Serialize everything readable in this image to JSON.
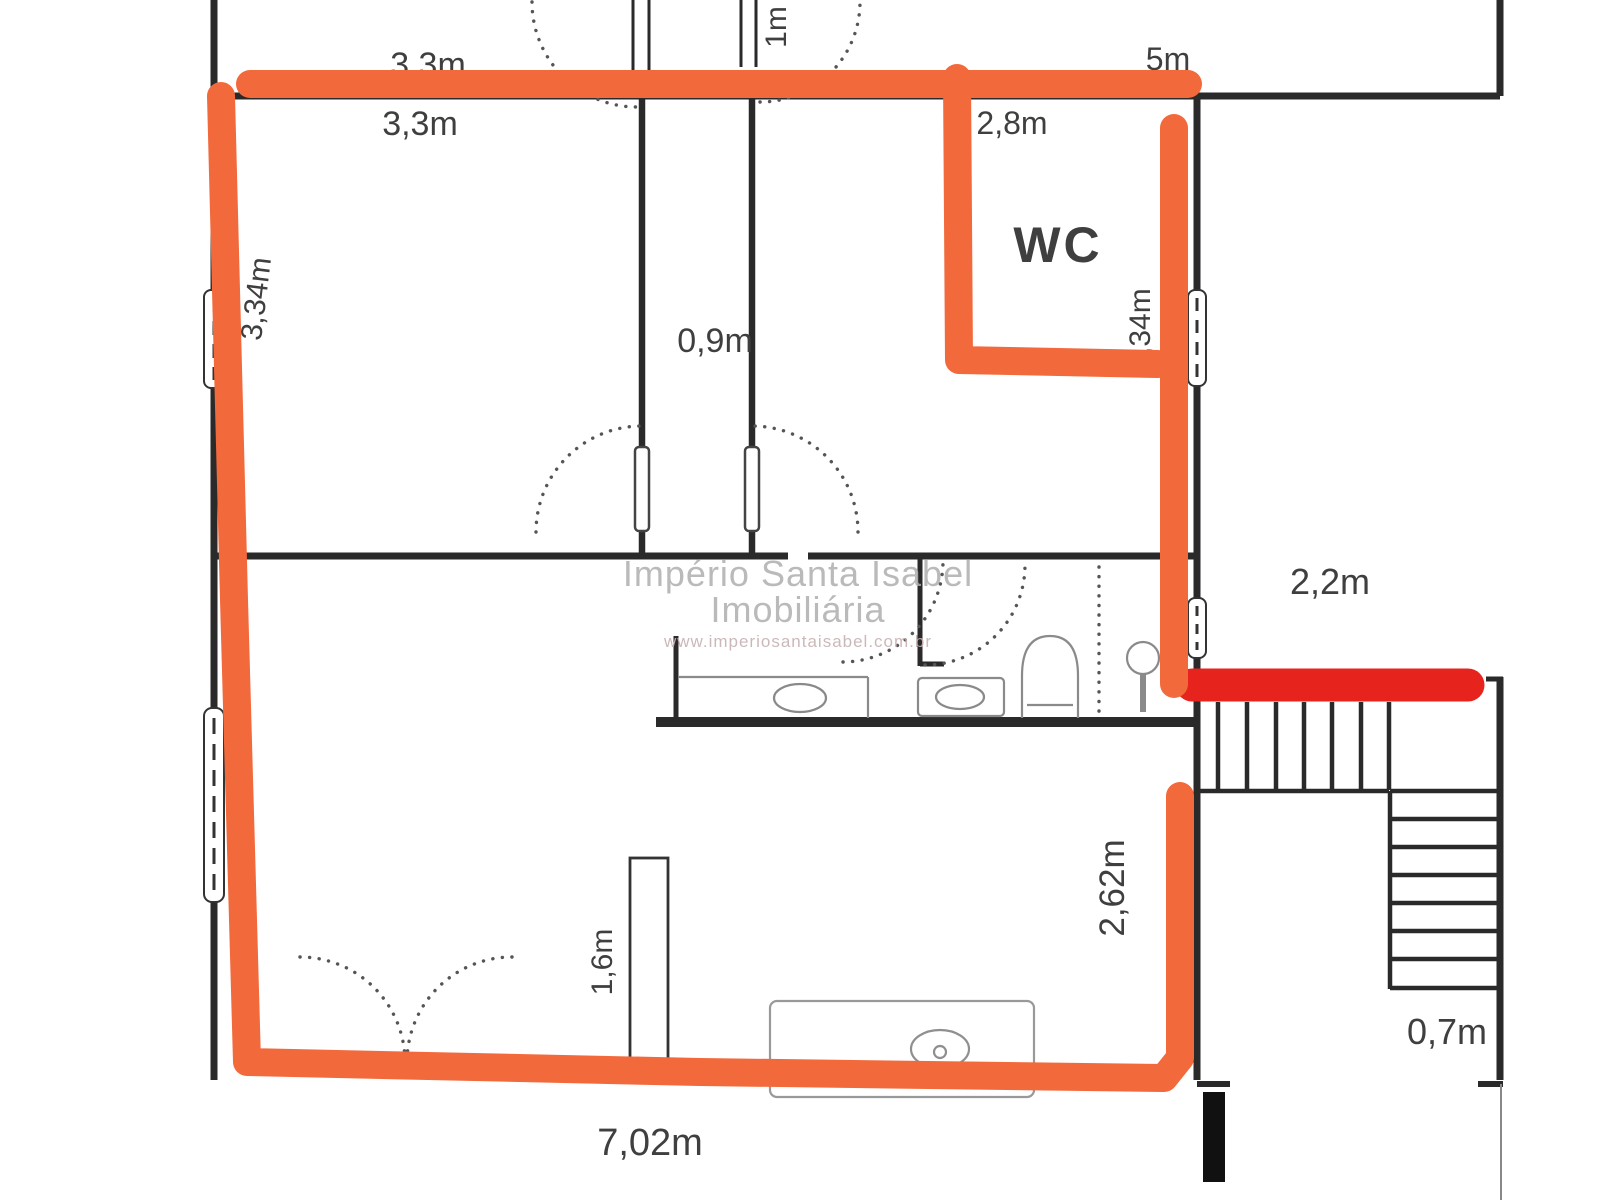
{
  "document_type": "floor-plan-photo",
  "colors": {
    "highlight_orange": "#f2693c",
    "marker_red": "#e6231c",
    "wall_black": "#2a2a2a",
    "fixture_gray": "#8a8a8a",
    "background": "#ffffff"
  },
  "rooms": {
    "wc_label": "WC"
  },
  "dimensions": {
    "top_width": "3,3m",
    "bedroom1_width": "3,3m",
    "entry_door": "1m",
    "top_right_width": "5m",
    "wc_width": "2,8m",
    "wc_height": "2,34m",
    "bedroom1_height": "3,34m",
    "corridor_width": "0,9m",
    "hall_width": "2,2m",
    "kitchen_height": "2,62m",
    "counter_length": "1,6m",
    "bottom_width": "7,02m",
    "stair_width": "0,7m"
  },
  "watermark": {
    "line1": "Império Santa Isabel",
    "line2": "Imobiliária",
    "line3": "www.imperiosantaisabel.com.br"
  }
}
